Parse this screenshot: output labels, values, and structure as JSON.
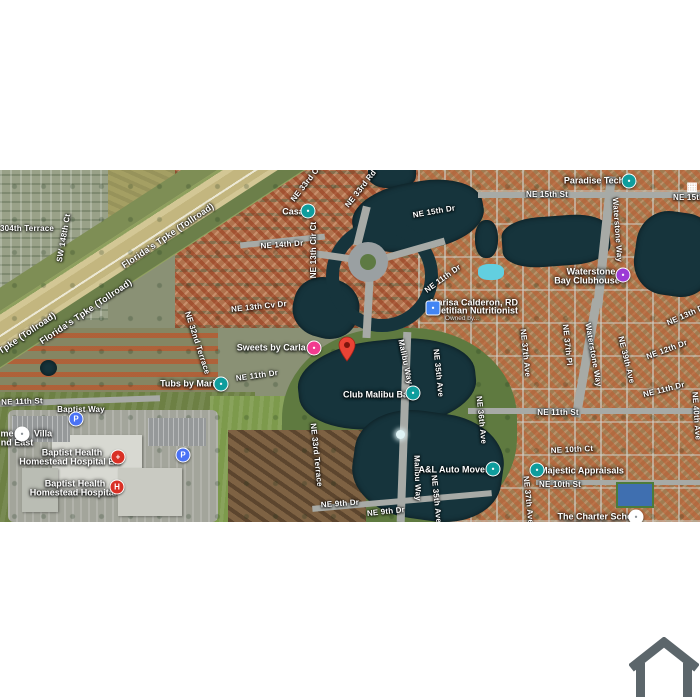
{
  "meta": {
    "view": "satellite-map"
  },
  "colors": {
    "band": "#FFFFFF",
    "land_base": "#8A9175",
    "water": "#16343C",
    "highway": "#C9BD8A",
    "road": "#A7AAA6",
    "poi_teal": "#0F9D9D",
    "poi_pink": "#F23B8F",
    "poi_purple": "#9C3BD6",
    "poi_blue": "#4285F4",
    "poi_red": "#D93025",
    "parking_blue": "#4A72F5",
    "pin_red": "#EA4335",
    "pin_dark": "#7E150D",
    "logo_gray": "#5C666B"
  },
  "marker": {
    "name": "dropped-pin",
    "x": 347,
    "y": 362
  },
  "road_labels": [
    {
      "text": "304th Terrace",
      "x": 27,
      "y": 229,
      "rot": 0
    },
    {
      "text": "SW 148th Ct",
      "x": 64,
      "y": 238,
      "rot": -80
    },
    {
      "text": "Florida's Tpke (Tollroad)",
      "x": 168,
      "y": 236,
      "rot": -34,
      "cls": "hwy-lbl"
    },
    {
      "text": "Florida's Tpke (Tollroad)",
      "x": 86,
      "y": 312,
      "rot": -34,
      "cls": "hwy-lbl"
    },
    {
      "text": "Florida's Tpke (Tollroad)",
      "x": 10,
      "y": 345,
      "rot": -34,
      "cls": "hwy-lbl"
    },
    {
      "text": "NE 33rd Ct",
      "x": 306,
      "y": 184,
      "rot": -52
    },
    {
      "text": "NE 33rd Rd",
      "x": 361,
      "y": 189,
      "rot": -52
    },
    {
      "text": "NE 15th Dr",
      "x": 434,
      "y": 212,
      "rot": -10
    },
    {
      "text": "NE 14th Dr",
      "x": 282,
      "y": 245,
      "rot": -4
    },
    {
      "text": "NE 13th Cir Ct",
      "x": 314,
      "y": 250,
      "rot": -90
    },
    {
      "text": "NE 13th Cv Dr",
      "x": 259,
      "y": 307,
      "rot": -6
    },
    {
      "text": "NE 15th St",
      "x": 547,
      "y": 195,
      "rot": 0
    },
    {
      "text": "NE 15th St",
      "x": 694,
      "y": 198,
      "rot": 0
    },
    {
      "text": "Waterstone Way",
      "x": 617,
      "y": 230,
      "rot": 86
    },
    {
      "text": "NE 32nd Terrace",
      "x": 197,
      "y": 343,
      "rot": 72
    },
    {
      "text": "NE 11th Dr",
      "x": 257,
      "y": 376,
      "rot": -8
    },
    {
      "text": "NE 11th St",
      "x": 22,
      "y": 402,
      "rot": -2
    },
    {
      "text": "Baptist Way",
      "x": 81,
      "y": 410,
      "rot": 0
    },
    {
      "text": "NE 11th Dr",
      "x": 443,
      "y": 279,
      "rot": -36
    },
    {
      "text": "NE 9th Dr",
      "x": 340,
      "y": 504,
      "rot": -4
    },
    {
      "text": "NE 9th Dr",
      "x": 386,
      "y": 512,
      "rot": -6
    },
    {
      "text": "NE 33rd Terrace",
      "x": 316,
      "y": 455,
      "rot": 84
    },
    {
      "text": "Malibu Way",
      "x": 405,
      "y": 362,
      "rot": 78
    },
    {
      "text": "Malibu Way",
      "x": 417,
      "y": 478,
      "rot": 88
    },
    {
      "text": "NE 35th Ave",
      "x": 438,
      "y": 373,
      "rot": 84
    },
    {
      "text": "NE 35th Ave",
      "x": 436,
      "y": 499,
      "rot": 84
    },
    {
      "text": "NE 36th Ave",
      "x": 481,
      "y": 420,
      "rot": 84
    },
    {
      "text": "NE 37th Ave",
      "x": 525,
      "y": 353,
      "rot": 84
    },
    {
      "text": "NE 37th Pl",
      "x": 567,
      "y": 345,
      "rot": 84
    },
    {
      "text": "NE 37th Ave",
      "x": 528,
      "y": 500,
      "rot": 84
    },
    {
      "text": "NE 11th St",
      "x": 558,
      "y": 413,
      "rot": 0
    },
    {
      "text": "NE 10th Ct",
      "x": 572,
      "y": 450,
      "rot": -3
    },
    {
      "text": "NE 10th St",
      "x": 560,
      "y": 485,
      "rot": 0
    },
    {
      "text": "Waterstone Way",
      "x": 593,
      "y": 355,
      "rot": 80
    },
    {
      "text": "NE 39th Ave",
      "x": 626,
      "y": 360,
      "rot": 76
    },
    {
      "text": "NE 13th Dr",
      "x": 687,
      "y": 315,
      "rot": -24
    },
    {
      "text": "NE 12th Dr",
      "x": 667,
      "y": 350,
      "rot": -20
    },
    {
      "text": "NE 11th Dr",
      "x": 664,
      "y": 390,
      "rot": -14
    },
    {
      "text": "NE 40th Ave",
      "x": 696,
      "y": 416,
      "rot": 86
    }
  ],
  "poi_labels": [
    {
      "name": "poi-label-casa",
      "text": "Casa",
      "x": 293,
      "y": 212
    },
    {
      "name": "poi-label-paradise-tech",
      "text": "Paradise Tech",
      "x": 594,
      "y": 181
    },
    {
      "name": "poi-label-sweets",
      "text": "Sweets by Carla G",
      "x": 276,
      "y": 348
    },
    {
      "name": "poi-label-tubs",
      "text": "Tubs by Maria",
      "x": 190,
      "y": 384
    },
    {
      "name": "poi-label-club-malibu-bay",
      "text": "Club Malibu Bay",
      "x": 378,
      "y": 395
    },
    {
      "name": "poi-label-clubhouse-1",
      "text": "Waterstone",
      "x": 591,
      "y": 272
    },
    {
      "name": "poi-label-clubhouse-2",
      "text": "Bay Clubhouse",
      "x": 587,
      "y": 281
    },
    {
      "name": "poi-label-dietitian-1",
      "text": "Marisa Calderon, RD",
      "x": 474,
      "y": 303
    },
    {
      "name": "poi-label-dietitian-2",
      "text": "Dietitian Nutritionist",
      "x": 475,
      "y": 311
    },
    {
      "name": "poi-label-dietitian-3",
      "text": "Owned by...",
      "x": 462,
      "y": 319,
      "cls": "sub-lbl"
    },
    {
      "name": "poi-label-er-1",
      "text": "Baptist Health",
      "x": 72,
      "y": 453
    },
    {
      "name": "poi-label-er-2",
      "text": "Homestead Hospital ER",
      "x": 70,
      "y": 462
    },
    {
      "name": "poi-label-hospital-1",
      "text": "Baptist Health",
      "x": 75,
      "y": 484
    },
    {
      "name": "poi-label-hospital-2",
      "text": "Homestead Hospital",
      "x": 73,
      "y": 493
    },
    {
      "name": "poi-label-majestic",
      "text": "Majestic Appraisals",
      "x": 582,
      "y": 471
    },
    {
      "name": "poi-label-movers",
      "text": "A&L Auto Movers",
      "x": 456,
      "y": 470
    },
    {
      "name": "poi-label-school-1",
      "text": "The Charter School",
      "x": 599,
      "y": 517
    },
    {
      "name": "poi-label-school-2",
      "text": "at Waterstone",
      "x": 592,
      "y": 526
    },
    {
      "name": "poi-label-villa-1",
      "text": "me",
      "x": 7,
      "y": 434
    },
    {
      "name": "poi-label-villa-2",
      "text": "Villa",
      "x": 43,
      "y": 434
    },
    {
      "name": "poi-label-villa-3",
      "text": "nd East",
      "x": 17,
      "y": 443
    }
  ],
  "icons": [
    {
      "name": "casa-poi-icon",
      "x": 308,
      "y": 211,
      "shape": "circle",
      "color": "#0F9D9D",
      "glyph": "•"
    },
    {
      "name": "paradise-tech-poi-icon",
      "x": 629,
      "y": 181,
      "shape": "circle",
      "color": "#0F9D9D",
      "glyph": "•"
    },
    {
      "name": "sweets-poi-icon",
      "x": 314,
      "y": 348,
      "shape": "circle",
      "color": "#F23B8F",
      "glyph": "•"
    },
    {
      "name": "tubs-poi-icon",
      "x": 221,
      "y": 384,
      "shape": "circle",
      "color": "#0F9D9D",
      "glyph": "•"
    },
    {
      "name": "club-malibu-bay-poi-icon",
      "x": 413,
      "y": 393,
      "shape": "circle",
      "color": "#0F9D9D",
      "glyph": "•"
    },
    {
      "name": "clubhouse-poi-icon",
      "x": 623,
      "y": 275,
      "shape": "circle",
      "color": "#9C3BD6",
      "glyph": "•"
    },
    {
      "name": "dietitian-poi-icon",
      "x": 433,
      "y": 308,
      "shape": "square",
      "color": "#4285F4",
      "glyph": "•"
    },
    {
      "name": "er-poi-icon",
      "x": 118,
      "y": 457,
      "shape": "circle",
      "color": "#D93025",
      "glyph": "+"
    },
    {
      "name": "hospital-poi-icon",
      "x": 117,
      "y": 487,
      "shape": "circle",
      "color": "#D93025",
      "glyph": "H"
    },
    {
      "name": "parking-icon",
      "x": 76,
      "y": 419,
      "shape": "circle",
      "color": "#4A72F5",
      "glyph": "P"
    },
    {
      "name": "parking-icon",
      "x": 183,
      "y": 455,
      "shape": "circle",
      "color": "#4A72F5",
      "glyph": "P"
    },
    {
      "name": "villa-poi-icon",
      "x": 22,
      "y": 434,
      "shape": "white",
      "color": "#FFFFFF",
      "glyph": "•"
    },
    {
      "name": "school-poi-icon",
      "x": 636,
      "y": 517,
      "shape": "white",
      "color": "#FFFFFF",
      "glyph": "•"
    },
    {
      "name": "apartments-grid-icon",
      "x": 692,
      "y": 186,
      "shape": "grid",
      "color": "#FFFFFF",
      "glyph": "▦"
    },
    {
      "name": "majestic-poi-icon",
      "x": 537,
      "y": 470,
      "shape": "circle",
      "color": "#0F9D9D",
      "glyph": "•"
    },
    {
      "name": "movers-poi-icon",
      "x": 493,
      "y": 469,
      "shape": "circle",
      "color": "#0F9D9D",
      "glyph": "•"
    }
  ],
  "logo": {
    "name": "house-logo"
  }
}
